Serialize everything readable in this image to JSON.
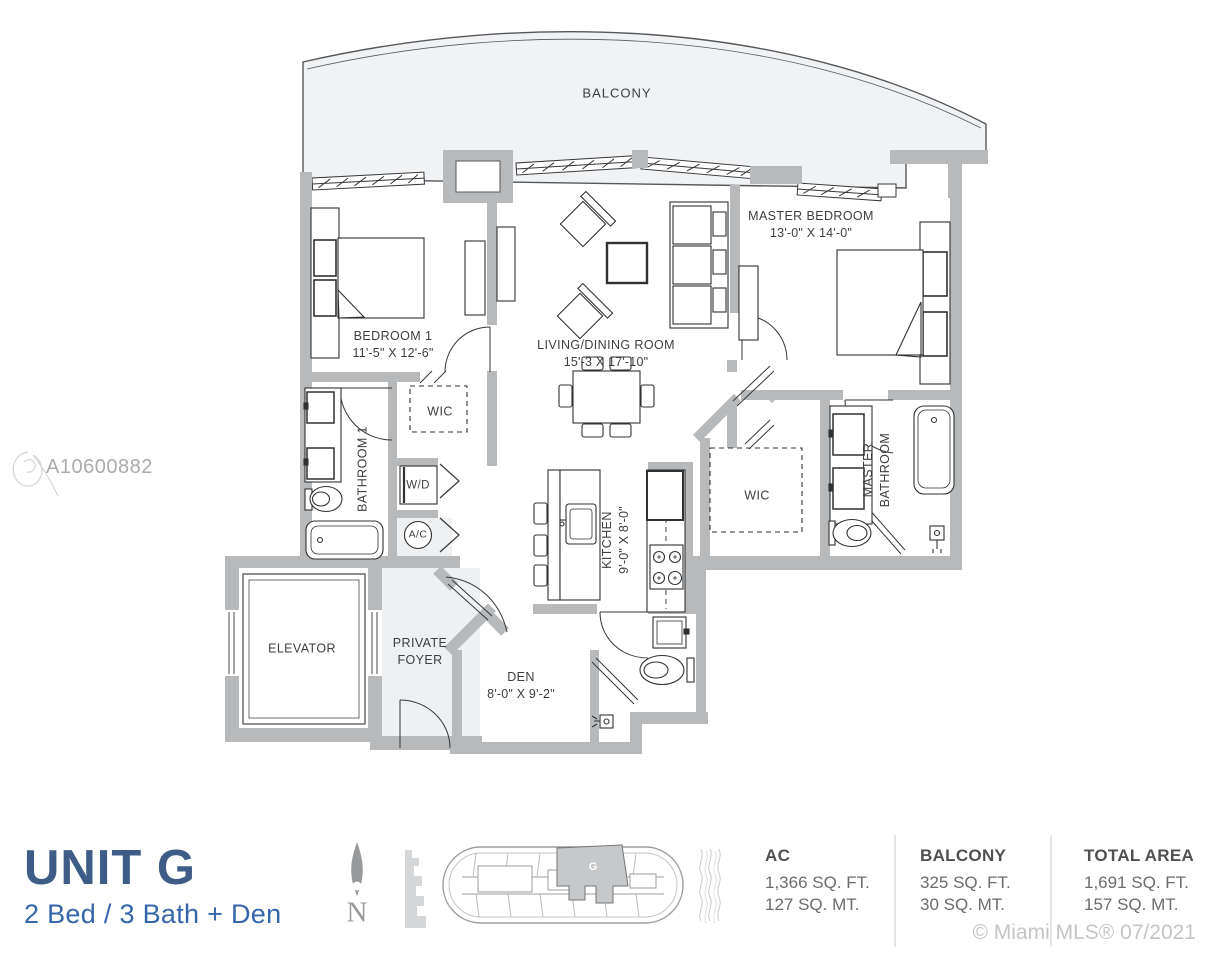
{
  "watermark": {
    "id": "A10600882"
  },
  "plan": {
    "balcony": {
      "label": "BALCONY"
    },
    "bedroom1": {
      "label": "BEDROOM 1",
      "dims": "11'-5\" X 12'-6\""
    },
    "living_dining": {
      "label": "LIVING/DINING ROOM",
      "dims": "15'-3 X 17'-10\""
    },
    "master_bedroom": {
      "label": "MASTER BEDROOM",
      "dims": "13'-0\" X 14'-0\""
    },
    "wic_1": {
      "label": "WIC"
    },
    "bathroom_1": {
      "label": "BATHROOM 1"
    },
    "washer_dryer": {
      "label": "W/D"
    },
    "ac": {
      "label": "A/C"
    },
    "kitchen": {
      "label": "KITCHEN",
      "dims": "9'-0\" X 8'-0\""
    },
    "wic_2": {
      "label": "WIC"
    },
    "master_bathroom": {
      "label": "MASTER BATHROOM"
    },
    "elevator": {
      "label": "ELEVATOR"
    },
    "private_foyer": {
      "label": "PRIVATE FOYER"
    },
    "den": {
      "label": "DEN",
      "dims": "8'-0\" X 9'-2\""
    }
  },
  "footer": {
    "unit_title": "UNIT G",
    "unit_subtitle": "2 Bed / 3 Bath + Den",
    "north_label": "N",
    "keyplan_unit_label": "G",
    "stats": [
      {
        "label": "AC",
        "imperial": "1,366 SQ. FT.",
        "metric": "127 SQ. MT."
      },
      {
        "label": "BALCONY",
        "imperial": "325 SQ. FT.",
        "metric": "30 SQ. MT."
      },
      {
        "label": "TOTAL AREA",
        "imperial": "1,691 SQ. FT.",
        "metric": "157 SQ. MT."
      }
    ],
    "copyright": "© Miami MLS® 07/2021"
  },
  "colors": {
    "title_blue": "#3d5c88",
    "subtitle_blue": "#3566ab",
    "wall_gray": "#b7b9bb",
    "balcony_fill": "#f0f2f4",
    "keyplan_highlight": "#c6c8ca",
    "muted_gray": "#97999b"
  },
  "icons": {
    "north_arrow": "north-arrow-icon",
    "keyplan": "building-keyplan",
    "skyline": "city-silhouette-icon",
    "water": "water-waves-icon",
    "watermark_glyph": "mls-watermark-glyph"
  }
}
